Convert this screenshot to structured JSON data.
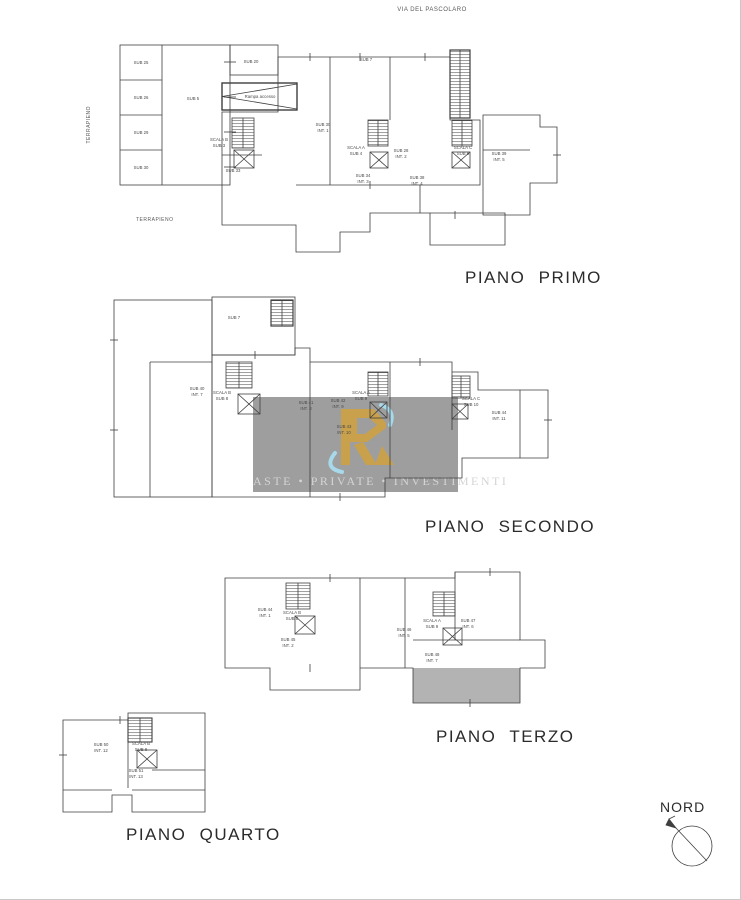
{
  "street_label": "VIA DEL PASCOLARO",
  "site": {
    "terrapieno_vertical": "TERRAPIENO",
    "terrapieno_horizontal": "TERRAPIENO"
  },
  "compass": {
    "label": "NORD"
  },
  "watermark": {
    "line": "ASTE • PRIVATE • INVESTIMENTI",
    "logo": "R-monogram",
    "colors": {
      "panel": "#9e9e9e",
      "gold": "#c9a14d",
      "blue": "#a7d9ea",
      "text": "#d4d4d4"
    }
  },
  "plans": {
    "primo": {
      "caption": "PIANO PRIMO",
      "labels": [
        {
          "t": "SUB 25",
          "x": 141,
          "y": 64
        },
        {
          "t": "SUB 26",
          "x": 141,
          "y": 99
        },
        {
          "t": "SUB 29",
          "x": 141,
          "y": 134
        },
        {
          "t": "SUB 30",
          "x": 141,
          "y": 169
        },
        {
          "t": "SUB 5",
          "x": 193,
          "y": 100
        },
        {
          "t": "SUB 20",
          "x": 251,
          "y": 63
        },
        {
          "t": "Rampa accesso",
          "x": 260,
          "y": 98
        },
        {
          "t": "SUB 7",
          "x": 366,
          "y": 61
        },
        {
          "t": "SCALA B",
          "x": 219,
          "y": 141
        },
        {
          "t": "SUB 3",
          "x": 219,
          "y": 147
        },
        {
          "t": "SUB 30",
          "x": 323,
          "y": 126
        },
        {
          "t": "INT. 1",
          "x": 323,
          "y": 132
        },
        {
          "t": "SCALA A",
          "x": 356,
          "y": 149
        },
        {
          "t": "SUB 4",
          "x": 356,
          "y": 155
        },
        {
          "t": "SUB 28",
          "x": 401,
          "y": 152
        },
        {
          "t": "INT. 2",
          "x": 401,
          "y": 158
        },
        {
          "t": "SCALA C",
          "x": 463,
          "y": 149
        },
        {
          "t": "SUB 6",
          "x": 463,
          "y": 155
        },
        {
          "t": "SUB 39",
          "x": 499,
          "y": 155
        },
        {
          "t": "INT. 5",
          "x": 499,
          "y": 161
        },
        {
          "t": "SUB 34",
          "x": 363,
          "y": 177
        },
        {
          "t": "INT. 3",
          "x": 363,
          "y": 183
        },
        {
          "t": "SUB 38",
          "x": 417,
          "y": 179
        },
        {
          "t": "INT. 4",
          "x": 417,
          "y": 185
        },
        {
          "t": "SUB 33",
          "x": 233,
          "y": 172
        }
      ]
    },
    "secondo": {
      "caption": "PIANO SECONDO",
      "labels": [
        {
          "t": "SUB 7",
          "x": 234,
          "y": 319
        },
        {
          "t": "SUB 40",
          "x": 197,
          "y": 390
        },
        {
          "t": "INT. 7",
          "x": 197,
          "y": 396
        },
        {
          "t": "SCALA B",
          "x": 222,
          "y": 394
        },
        {
          "t": "SUB 8",
          "x": 222,
          "y": 400
        },
        {
          "t": "SUB 41",
          "x": 306,
          "y": 404
        },
        {
          "t": "INT. 8",
          "x": 306,
          "y": 410
        },
        {
          "t": "SUB 42",
          "x": 338,
          "y": 402
        },
        {
          "t": "INT. 9",
          "x": 338,
          "y": 408
        },
        {
          "t": "SCALA A",
          "x": 361,
          "y": 394
        },
        {
          "t": "SUB 9",
          "x": 361,
          "y": 400
        },
        {
          "t": "SUB 43",
          "x": 344,
          "y": 428
        },
        {
          "t": "INT. 10",
          "x": 344,
          "y": 434
        },
        {
          "t": "SCALA C",
          "x": 471,
          "y": 400
        },
        {
          "t": "SUB 10",
          "x": 471,
          "y": 406
        },
        {
          "t": "SUB 44",
          "x": 499,
          "y": 414
        },
        {
          "t": "INT. 11",
          "x": 499,
          "y": 420
        }
      ]
    },
    "terzo": {
      "caption": "PIANO TERZO",
      "labels": [
        {
          "t": "SUB 44",
          "x": 265,
          "y": 611
        },
        {
          "t": "INT. 1",
          "x": 265,
          "y": 617
        },
        {
          "t": "SCALA B",
          "x": 292,
          "y": 614
        },
        {
          "t": "SUB 8",
          "x": 292,
          "y": 620
        },
        {
          "t": "SUB 45",
          "x": 288,
          "y": 641
        },
        {
          "t": "INT. 2",
          "x": 288,
          "y": 647
        },
        {
          "t": "SUB 46",
          "x": 404,
          "y": 631
        },
        {
          "t": "INT. 5",
          "x": 404,
          "y": 637
        },
        {
          "t": "SCALA A",
          "x": 432,
          "y": 622
        },
        {
          "t": "SUB 9",
          "x": 432,
          "y": 628
        },
        {
          "t": "SUB 47",
          "x": 468,
          "y": 622
        },
        {
          "t": "INT. 6",
          "x": 468,
          "y": 628
        },
        {
          "t": "SUB 48",
          "x": 432,
          "y": 656
        },
        {
          "t": "INT. 7",
          "x": 432,
          "y": 662
        }
      ]
    },
    "quarto": {
      "caption": "PIANO QUARTO",
      "labels": [
        {
          "t": "SUB 50",
          "x": 101,
          "y": 746
        },
        {
          "t": "INT. 12",
          "x": 101,
          "y": 752
        },
        {
          "t": "SCALA B",
          "x": 141,
          "y": 745
        },
        {
          "t": "SUB 8",
          "x": 141,
          "y": 751
        },
        {
          "t": "SUB 51",
          "x": 136,
          "y": 772
        },
        {
          "t": "INT. 13",
          "x": 136,
          "y": 778
        }
      ]
    }
  }
}
